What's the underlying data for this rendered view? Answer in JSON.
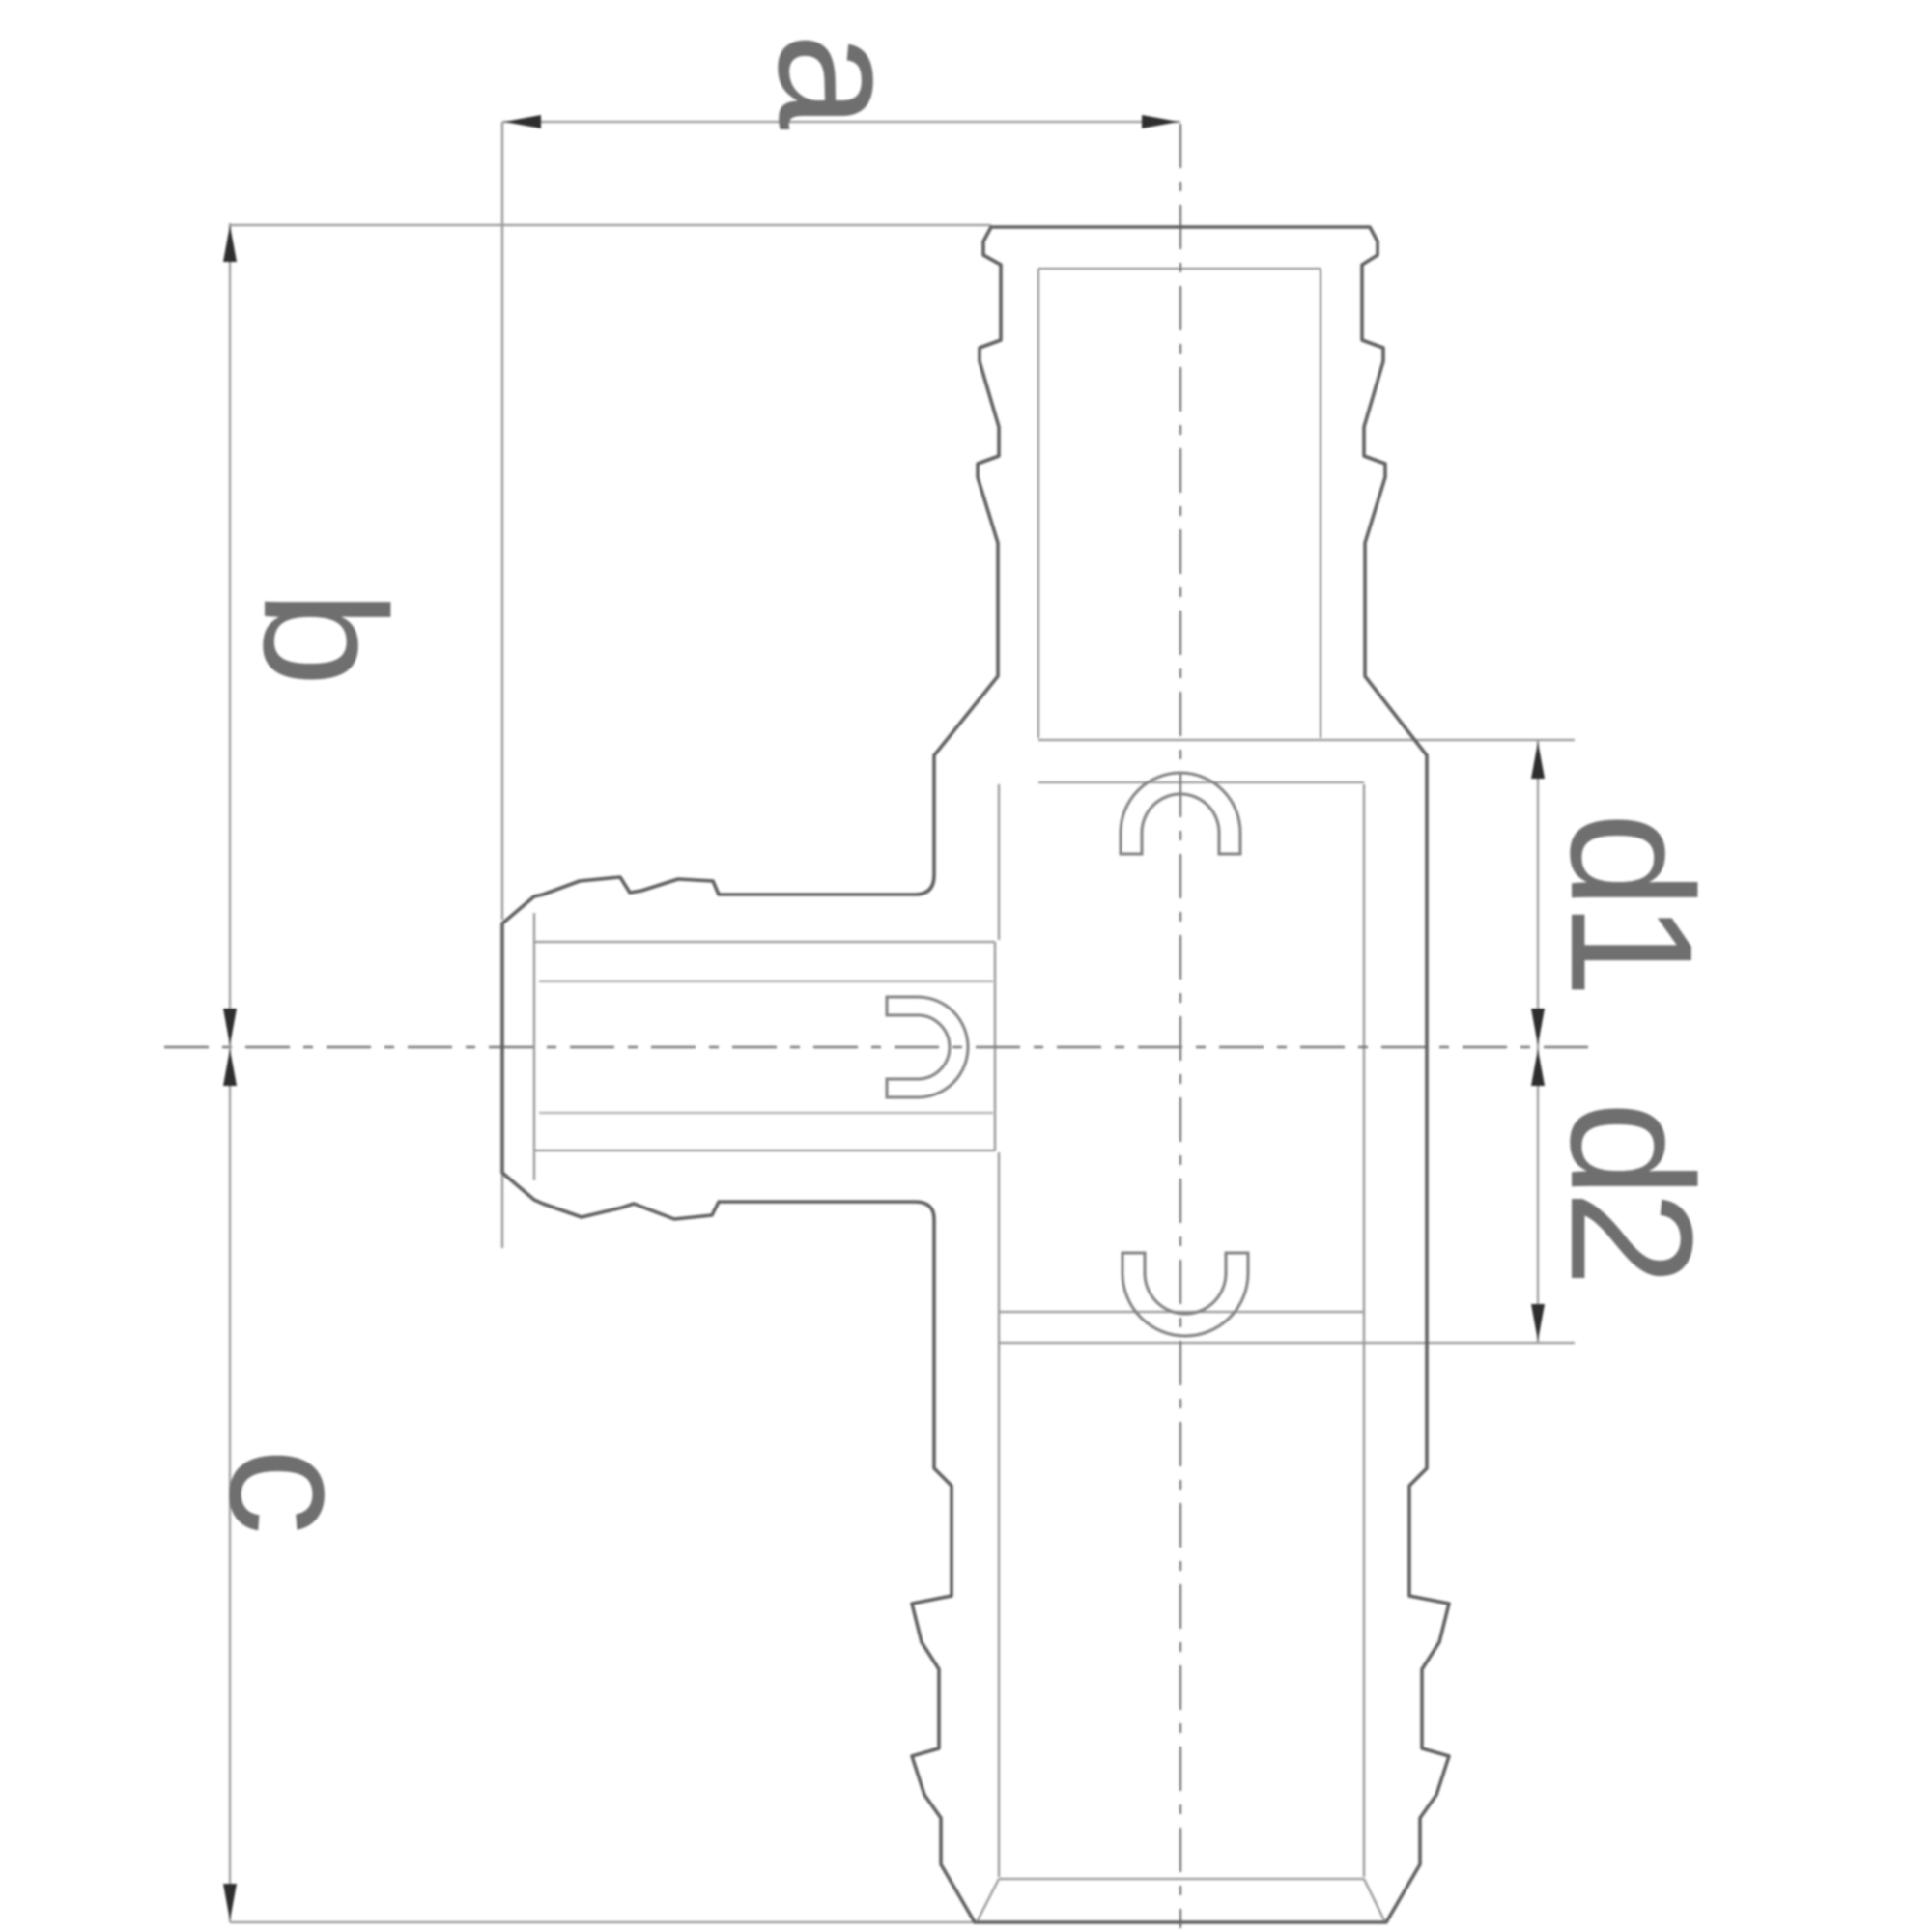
{
  "drawing": {
    "kind": "technical-drawing",
    "subject": "barbed reducing tee pipe fitting, sectioned side view with clip rings",
    "labels": {
      "a": "a",
      "b": "b",
      "c": "c",
      "d1": "d1",
      "d2": "d2"
    },
    "colors": {
      "background": "#ffffff",
      "outline": "#5f5f5f",
      "thin_line": "#989898",
      "centerline": "#7a7a7a",
      "clip": "#818181",
      "arrow": "#2e2e2e",
      "label": "#6f6f6f"
    }
  }
}
